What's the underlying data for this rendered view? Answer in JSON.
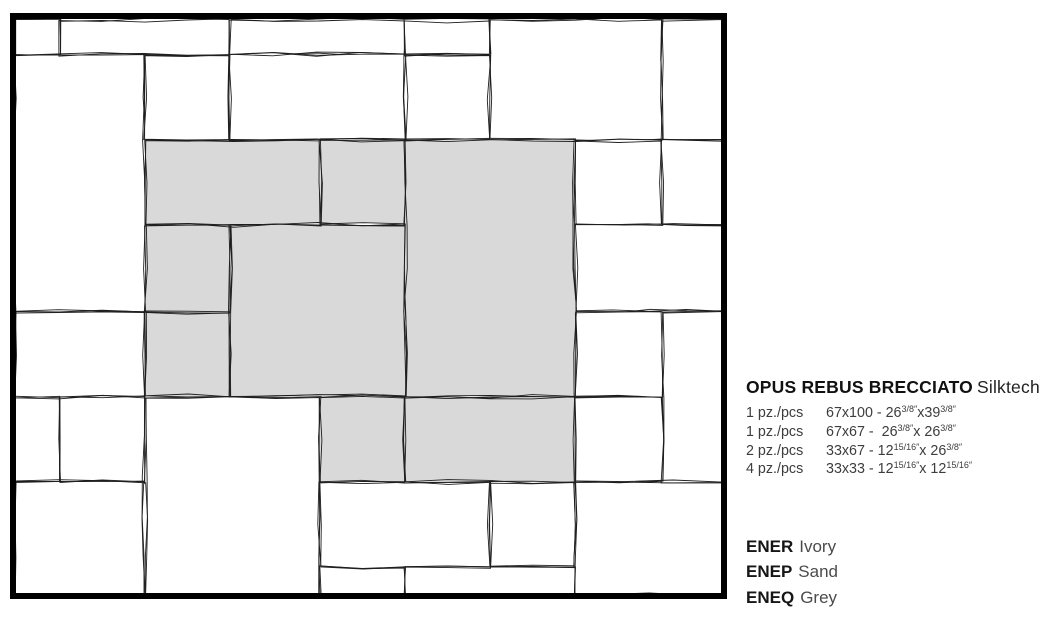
{
  "panel": {
    "title": {
      "name": "OPUS REBUS BRECCIATO",
      "finish": "Silktech"
    },
    "pieces": [
      {
        "qty": "1 pz./pcs",
        "size": "67x100 - 26{3/8″}x39{3/8″}"
      },
      {
        "qty": "1 pz./pcs",
        "size": "67x67 -  26{3/8″}x 26{3/8″}"
      },
      {
        "qty": "2 pz./pcs",
        "size": "33x67 - 12{15/16″}x 26{3/8″}"
      },
      {
        "qty": "4 pz./pcs",
        "size": "33x33 - 12{15/16″}x 12{15/16″}"
      }
    ],
    "colors": [
      {
        "code": "ENER",
        "name": "Ivory"
      },
      {
        "code": "ENEP",
        "name": "Sand"
      },
      {
        "code": "ENEQ",
        "name": "Grey"
      }
    ]
  },
  "diagram": {
    "border_color": "#000000",
    "line_color": "#1f1f1f",
    "tile_color": "#ffffff",
    "highlight_color": "#d9d9d9",
    "border": {
      "x": 10,
      "y": 13,
      "w": 717,
      "h": 586,
      "thickness": 6
    },
    "tiles": [
      {
        "x0": 15,
        "y0": 20,
        "x1": 60,
        "y1": 55,
        "shaded": false,
        "size": null
      },
      {
        "x0": 60,
        "y0": 20,
        "x1": 230,
        "y1": 55,
        "shaded": false,
        "size": null
      },
      {
        "x0": 230,
        "y0": 20,
        "x1": 405,
        "y1": 55,
        "shaded": false,
        "size": null
      },
      {
        "x0": 405,
        "y0": 20,
        "x1": 490,
        "y1": 55,
        "shaded": false,
        "size": null
      },
      {
        "x0": 490,
        "y0": 20,
        "x1": 662,
        "y1": 140,
        "shaded": false,
        "size": null
      },
      {
        "x0": 662,
        "y0": 20,
        "x1": 723,
        "y1": 140,
        "shaded": false,
        "size": null
      },
      {
        "x0": 15,
        "y0": 55,
        "x1": 145,
        "y1": 312,
        "shaded": false,
        "size": null
      },
      {
        "x0": 145,
        "y0": 55,
        "x1": 230,
        "y1": 140,
        "shaded": false,
        "size": "33x33"
      },
      {
        "x0": 230,
        "y0": 55,
        "x1": 405,
        "y1": 140,
        "shaded": false,
        "size": "33x67"
      },
      {
        "x0": 405,
        "y0": 55,
        "x1": 490,
        "y1": 140,
        "shaded": false,
        "size": "33x33"
      },
      {
        "x0": 145,
        "y0": 140,
        "x1": 320,
        "y1": 225,
        "shaded": true,
        "size": "33x67"
      },
      {
        "x0": 320,
        "y0": 140,
        "x1": 405,
        "y1": 225,
        "shaded": true,
        "size": "33x33"
      },
      {
        "x0": 405,
        "y0": 140,
        "x1": 575,
        "y1": 397,
        "shaded": true,
        "size": "67x100"
      },
      {
        "x0": 575,
        "y0": 140,
        "x1": 662,
        "y1": 225,
        "shaded": false,
        "size": "33x33"
      },
      {
        "x0": 662,
        "y0": 140,
        "x1": 723,
        "y1": 225,
        "shaded": false,
        "size": null
      },
      {
        "x0": 145,
        "y0": 225,
        "x1": 230,
        "y1": 312,
        "shaded": true,
        "size": "33x33"
      },
      {
        "x0": 230,
        "y0": 225,
        "x1": 405,
        "y1": 397,
        "shaded": true,
        "size": "67x67"
      },
      {
        "x0": 575,
        "y0": 225,
        "x1": 723,
        "y1": 312,
        "shaded": false,
        "size": null
      },
      {
        "x0": 15,
        "y0": 312,
        "x1": 145,
        "y1": 397,
        "shaded": false,
        "size": null
      },
      {
        "x0": 145,
        "y0": 312,
        "x1": 230,
        "y1": 397,
        "shaded": true,
        "size": "33x33"
      },
      {
        "x0": 575,
        "y0": 312,
        "x1": 662,
        "y1": 397,
        "shaded": false,
        "size": "33x33"
      },
      {
        "x0": 662,
        "y0": 312,
        "x1": 723,
        "y1": 482,
        "shaded": false,
        "size": null
      },
      {
        "x0": 15,
        "y0": 397,
        "x1": 60,
        "y1": 482,
        "shaded": false,
        "size": null
      },
      {
        "x0": 60,
        "y0": 397,
        "x1": 145,
        "y1": 482,
        "shaded": false,
        "size": "33x33"
      },
      {
        "x0": 145,
        "y0": 397,
        "x1": 320,
        "y1": 595,
        "shaded": false,
        "size": null
      },
      {
        "x0": 320,
        "y0": 397,
        "x1": 405,
        "y1": 482,
        "shaded": true,
        "size": "33x33"
      },
      {
        "x0": 405,
        "y0": 397,
        "x1": 575,
        "y1": 482,
        "shaded": true,
        "size": "33x67"
      },
      {
        "x0": 575,
        "y0": 397,
        "x1": 662,
        "y1": 482,
        "shaded": false,
        "size": "33x33"
      },
      {
        "x0": 15,
        "y0": 482,
        "x1": 145,
        "y1": 595,
        "shaded": false,
        "size": null
      },
      {
        "x0": 320,
        "y0": 482,
        "x1": 490,
        "y1": 567,
        "shaded": false,
        "size": "33x67"
      },
      {
        "x0": 490,
        "y0": 482,
        "x1": 575,
        "y1": 567,
        "shaded": false,
        "size": "33x33"
      },
      {
        "x0": 575,
        "y0": 482,
        "x1": 723,
        "y1": 595,
        "shaded": false,
        "size": null
      },
      {
        "x0": 320,
        "y0": 567,
        "x1": 405,
        "y1": 595,
        "shaded": false,
        "size": null
      },
      {
        "x0": 405,
        "y0": 567,
        "x1": 575,
        "y1": 595,
        "shaded": false,
        "size": null
      }
    ]
  }
}
